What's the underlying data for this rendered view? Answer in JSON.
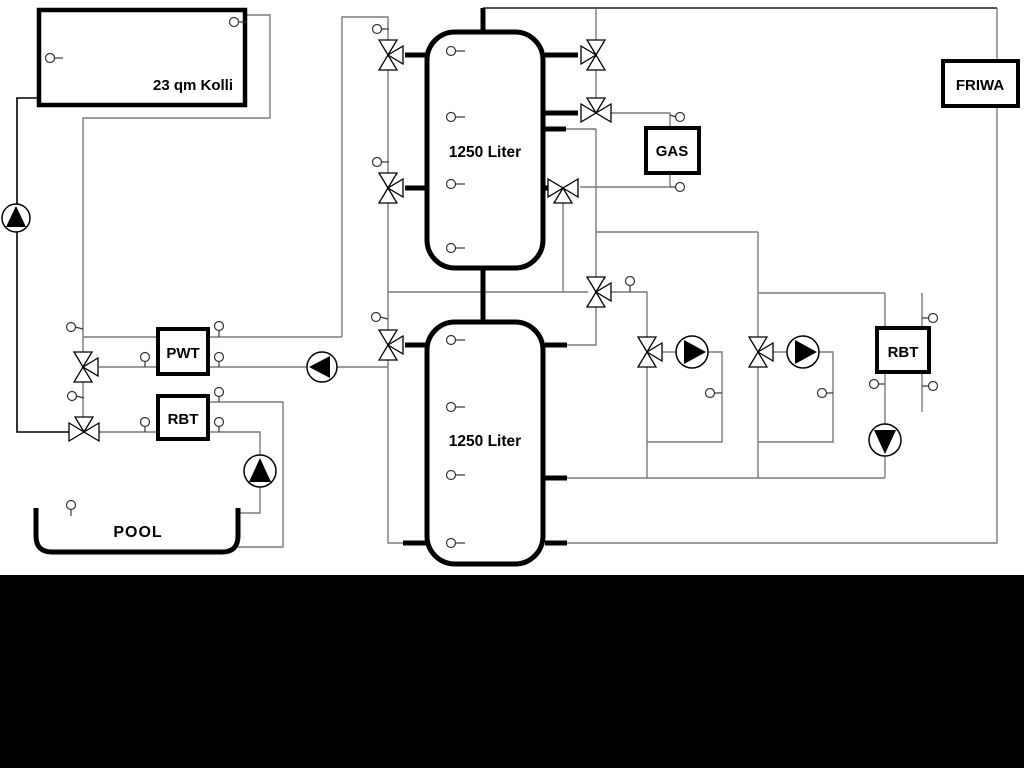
{
  "diagram": {
    "collector": {
      "label": "23 qm Kolli"
    },
    "upper_tank": {
      "label": "1250 Liter"
    },
    "lower_tank": {
      "label": "1250 Liter"
    },
    "gas_boiler": {
      "label": "GAS"
    },
    "fresh_water_station": {
      "label": "FRIWA"
    },
    "heat_exchanger": {
      "label": "PWT"
    },
    "return_limiter_pool": {
      "label": "RBT"
    },
    "return_limiter_heating": {
      "label": "RBT"
    },
    "pool": {
      "label": "POOL"
    }
  },
  "colors": {
    "pipe_gray": "#7a7a7a",
    "component_stroke": "#000000",
    "background": "#ffffff",
    "bottom_bar": "#000000"
  }
}
